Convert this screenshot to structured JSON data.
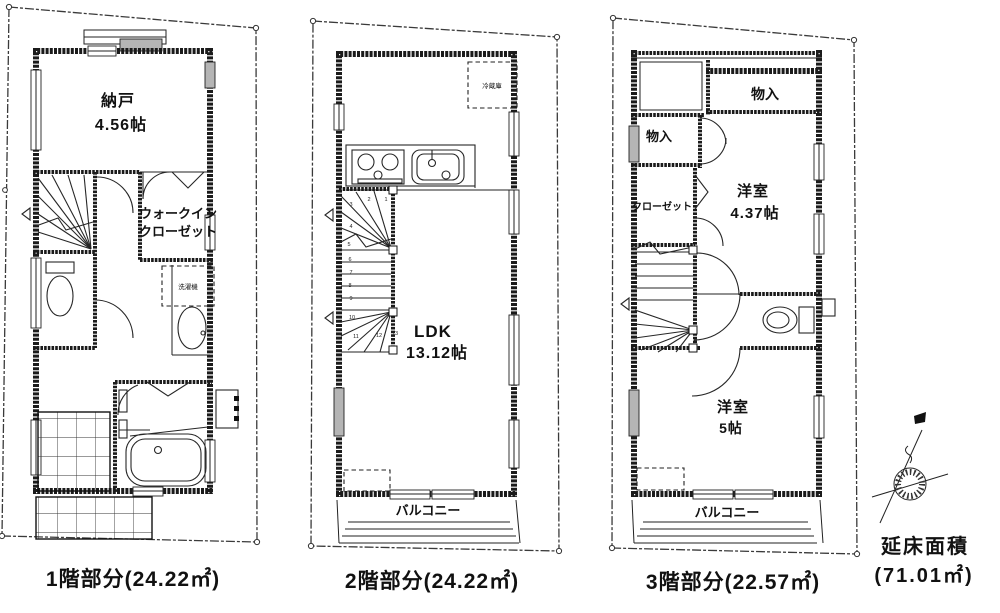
{
  "floor1": {
    "caption": "1階部分(24.22㎡)",
    "storage_room": {
      "name": "納戸",
      "size": "4.56帖"
    },
    "walkin_closet": {
      "line1": "ウォークイン",
      "line2": "クローゼット"
    },
    "washer_label": "洗濯機"
  },
  "floor2": {
    "caption": "2階部分(24.22㎡)",
    "ldk": {
      "name": "LDK",
      "size": "13.12帖"
    },
    "fridge_label": "冷蔵庫",
    "balcony_label": "バルコニー",
    "stair_numbers": [
      "1",
      "2",
      "3",
      "4",
      "5",
      "6",
      "7",
      "8",
      "9",
      "10",
      "11",
      "12",
      "13"
    ]
  },
  "floor3": {
    "caption": "3階部分(22.57㎡)",
    "storage_top_label": "物入",
    "storage_left_label": "物入",
    "closet_label": "クローゼット",
    "room_a": {
      "name": "洋室",
      "size": "4.37帖"
    },
    "room_b": {
      "name": "洋室",
      "size": "5帖"
    },
    "balcony_label": "バルコニー"
  },
  "total_area": {
    "line1": "延床面積",
    "line2": "(71.01㎡)"
  },
  "colors": {
    "line": "#1b1b1b",
    "background": "#ffffff"
  }
}
